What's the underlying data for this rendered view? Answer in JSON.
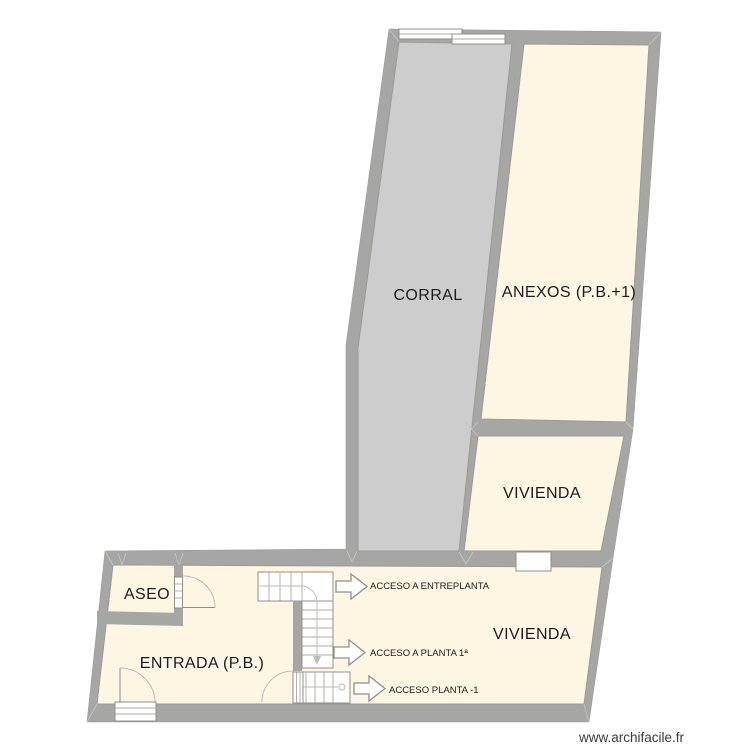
{
  "plan": {
    "rooms": {
      "corral": {
        "label": "CORRAL"
      },
      "anexos": {
        "label": "ANEXOS (P.B.+1)"
      },
      "vivienda_media": {
        "label": "VIVIENDA"
      },
      "aseo": {
        "label": "ASEO"
      },
      "entrada": {
        "label": "ENTRADA (P.B.)"
      },
      "vivienda_baja": {
        "label": "VIVIENDA"
      }
    },
    "annotations": {
      "acceso_entreplanta": {
        "label": "ACCESO A ENTREPLANTA"
      },
      "acceso_planta1": {
        "label": "ACCESO A PLANTA 1ª"
      },
      "acceso_planta_m1": {
        "label": "ACCESO PLANTA -1"
      }
    },
    "watermark": "www.archifacile.fr",
    "colors": {
      "wall": "#a6a6a4",
      "room-warm": "#fdf6e3",
      "room-gray": "#cdcdcd",
      "text": "#1c1c1c"
    }
  }
}
